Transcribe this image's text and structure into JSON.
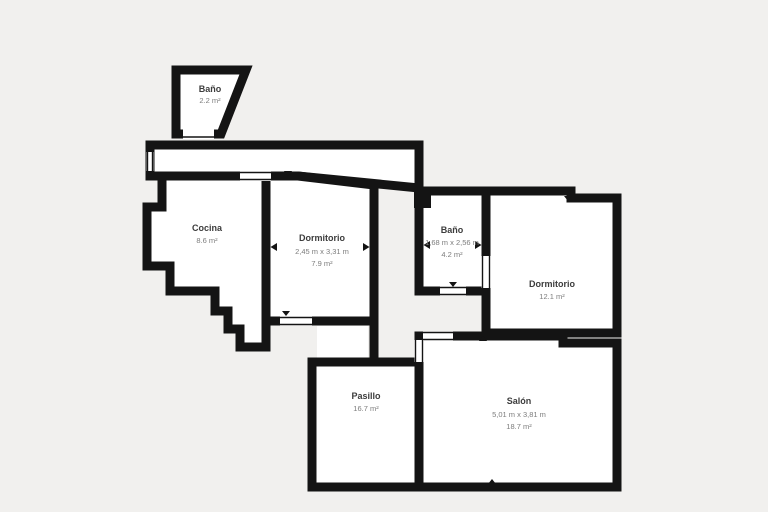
{
  "colors": {
    "background": "#f1f0ee",
    "wall": "#141414",
    "room_fill": "#ffffff",
    "name_text": "#3c3c3c",
    "dim_text": "#7d7d7d"
  },
  "rooms": [
    {
      "id": "bano-top",
      "name": "Baño",
      "area": "2.2 m²"
    },
    {
      "id": "cocina",
      "name": "Cocina",
      "area": "8.6 m²"
    },
    {
      "id": "dormitorio-left",
      "name": "Dormitorio",
      "dims": "2,45 m x 3,31 m",
      "area": "7.9 m²"
    },
    {
      "id": "bano-mid",
      "name": "Baño",
      "dims": "1,68 m x 2,56 m",
      "area": "4.2 m²"
    },
    {
      "id": "dormitorio-right",
      "name": "Dormitorio",
      "area": "12.1 m²"
    },
    {
      "id": "pasillo",
      "name": "Pasillo",
      "area": "16.7 m²"
    },
    {
      "id": "salon",
      "name": "Salón",
      "dims": "5,01 m x 3,81 m",
      "area": "18.7 m²"
    }
  ]
}
